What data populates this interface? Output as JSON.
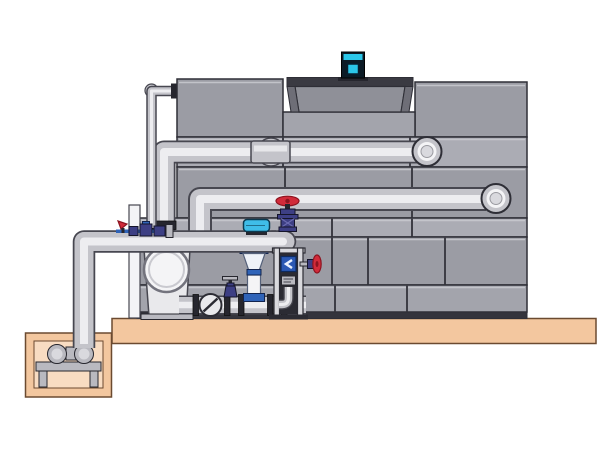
{
  "scene": {
    "type": "technical-illustration",
    "subject": "closed-circuit cooling tower with pump skid, sump pit and concrete platform",
    "parts": [
      "cooling-tower-shell",
      "tower-fan-cowl",
      "fan-motor",
      "tower-upper-left-panel",
      "tower-upper-right-panel",
      "tower-panel-band-a",
      "tower-panel-band-b",
      "tower-panel-band-c",
      "tower-panel-band-d",
      "tower-panel-band-e",
      "tower-base-strip",
      "upper-horizontal-pipe",
      "middle-horizontal-pipe",
      "makeup-water-pipe",
      "main-suction-pipe",
      "sump-riser-pipe",
      "pump-discharge-pipe",
      "centrifugal-pump",
      "sump-pit",
      "sump-pump",
      "concrete-platform",
      "check-valve",
      "gate-valve",
      "control-valve",
      "globe-valve-red-handwheel",
      "side-valve-red-handwheel",
      "flow-meter",
      "pipe-support-frame",
      "riser-cone-diffuser",
      "valve-cluster",
      "pipe-coupling",
      "pipe-elbow-cap"
    ]
  },
  "colors": {
    "bg": "#ffffff",
    "tower_panel": "#9b9ca4",
    "tower_panel_light": "#abacb4",
    "tower_panel_mid": "#a3a4ac",
    "tower_outline": "#2e2e36",
    "tower_seam": "#3e3e46",
    "panel_highlight": "#c9cad0",
    "tower_base": "#34343c",
    "cowl_dark": "#3a3a42",
    "cowl_side": "#6e6e77",
    "cowl_face": "#8f9098",
    "motor_body": "#0c1b26",
    "motor_cyan": "#2bc7e9",
    "pipe_outline": "#474750",
    "pipe_body": "#c4c4ca",
    "pipe_highlight": "#ededf0",
    "pipe_cap_inner": "#d9d9de",
    "pump_body": "#e9e9ec",
    "pump_ring": "#73737d",
    "white_part": "#f4f4f6",
    "gray_part": "#b9b9c0",
    "dark_part": "#26262e",
    "platform_fill": "#f3c79f",
    "platform_outline": "#6b4a30",
    "pit_inner": "#f8dcc2",
    "valve_red": "#d12b3a",
    "valve_red_dark": "#8c1420",
    "valve_navy": "#3d3f84",
    "valve_blue": "#2f63b8",
    "control_cyan": "#3fbde8",
    "cone_white": "#eef2f8",
    "meter_blue": "#2a58b4",
    "frame_light": "#d9d9dd",
    "frame_dark": "#2b2b33"
  }
}
